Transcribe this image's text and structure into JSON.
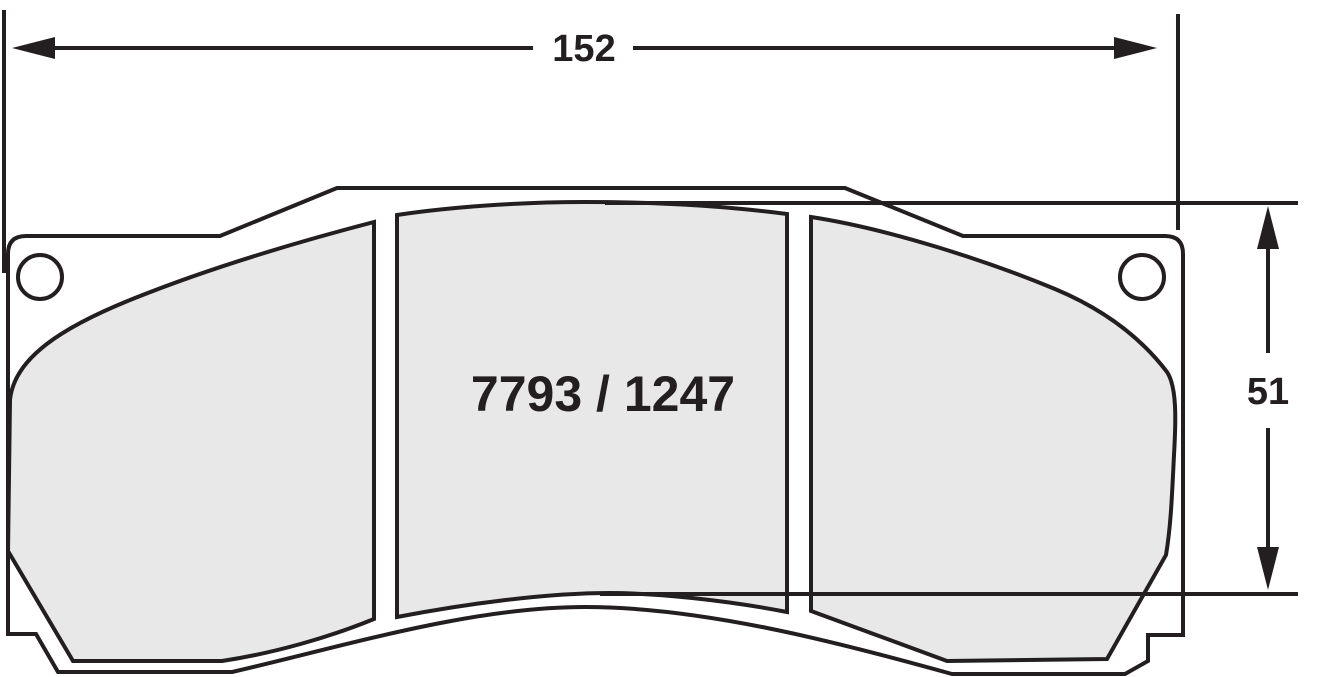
{
  "drawing": {
    "part_number": "7793 / 1247",
    "dimensions": {
      "width_mm": "152",
      "height_mm": "51"
    },
    "colors": {
      "line": "#231f20",
      "plate_fill": "#ffffff",
      "friction_fill": "#e8e8e8",
      "background": "#ffffff"
    }
  }
}
